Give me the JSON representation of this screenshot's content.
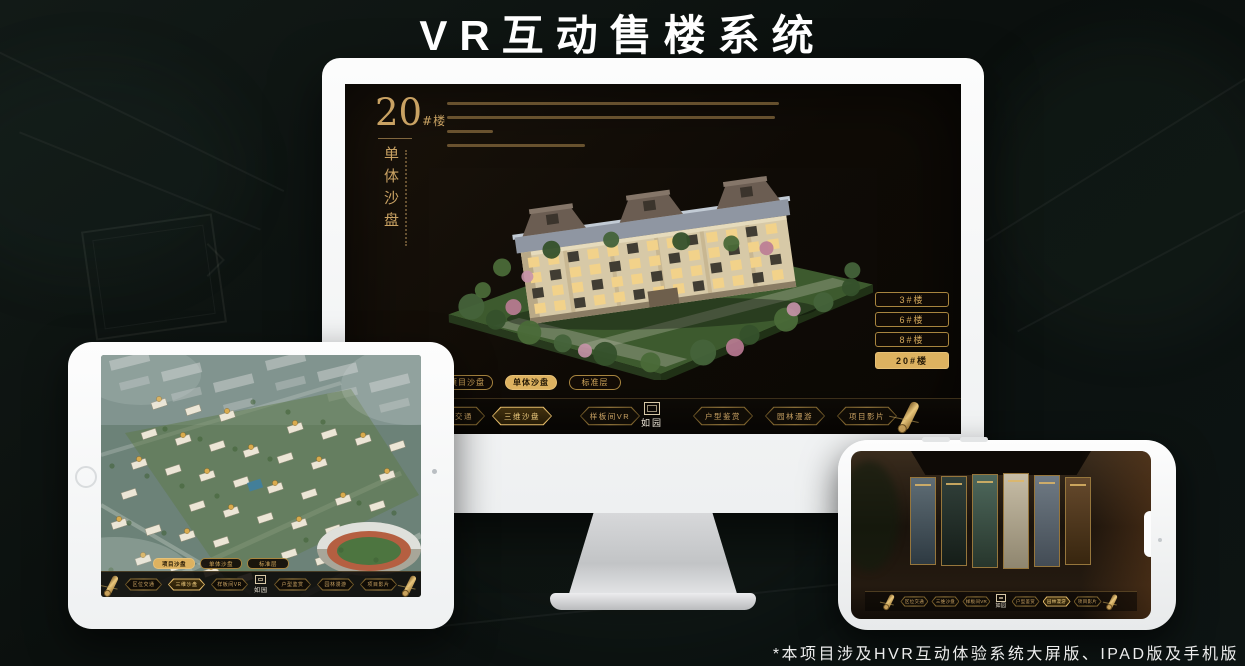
{
  "page": {
    "title": "VR互动售楼系统",
    "footnote": "*本项目涉及HVR互动体验系统大屏版、IPAD版及手机版"
  },
  "colors": {
    "gold_accent": "#c9a263",
    "gold_active": "#ddb260",
    "screen_background": "#14100a",
    "navbar_background": "#0b0804",
    "title_color": "#ffffff"
  },
  "menu": {
    "logo": "如园",
    "items": [
      {
        "label": "区位交通"
      },
      {
        "label": "三维沙盘"
      },
      {
        "label": "样板间VR"
      },
      {
        "label": "户型鉴赏"
      },
      {
        "label": "园林漫游"
      },
      {
        "label": "项目影片"
      }
    ]
  },
  "sub_tabs": [
    {
      "label": "项目沙盘"
    },
    {
      "label": "单体沙盘"
    },
    {
      "label": "标准层"
    }
  ],
  "desktop": {
    "heading": {
      "number": "20",
      "suffix": "#楼",
      "vertical": "单体沙盘"
    },
    "building_buttons": [
      {
        "label": "3#楼",
        "active": false
      },
      {
        "label": "6#楼",
        "active": false
      },
      {
        "label": "8#楼",
        "active": false
      },
      {
        "label": "20#楼",
        "active": true
      }
    ],
    "active_sub_tab": "单体沙盘",
    "active_menu_item": "三维沙盘"
  },
  "tablet": {
    "active_sub_tab": "项目沙盘",
    "active_menu_item": "三维沙盘"
  },
  "phone": {
    "active_menu_item": "园林漫游"
  }
}
